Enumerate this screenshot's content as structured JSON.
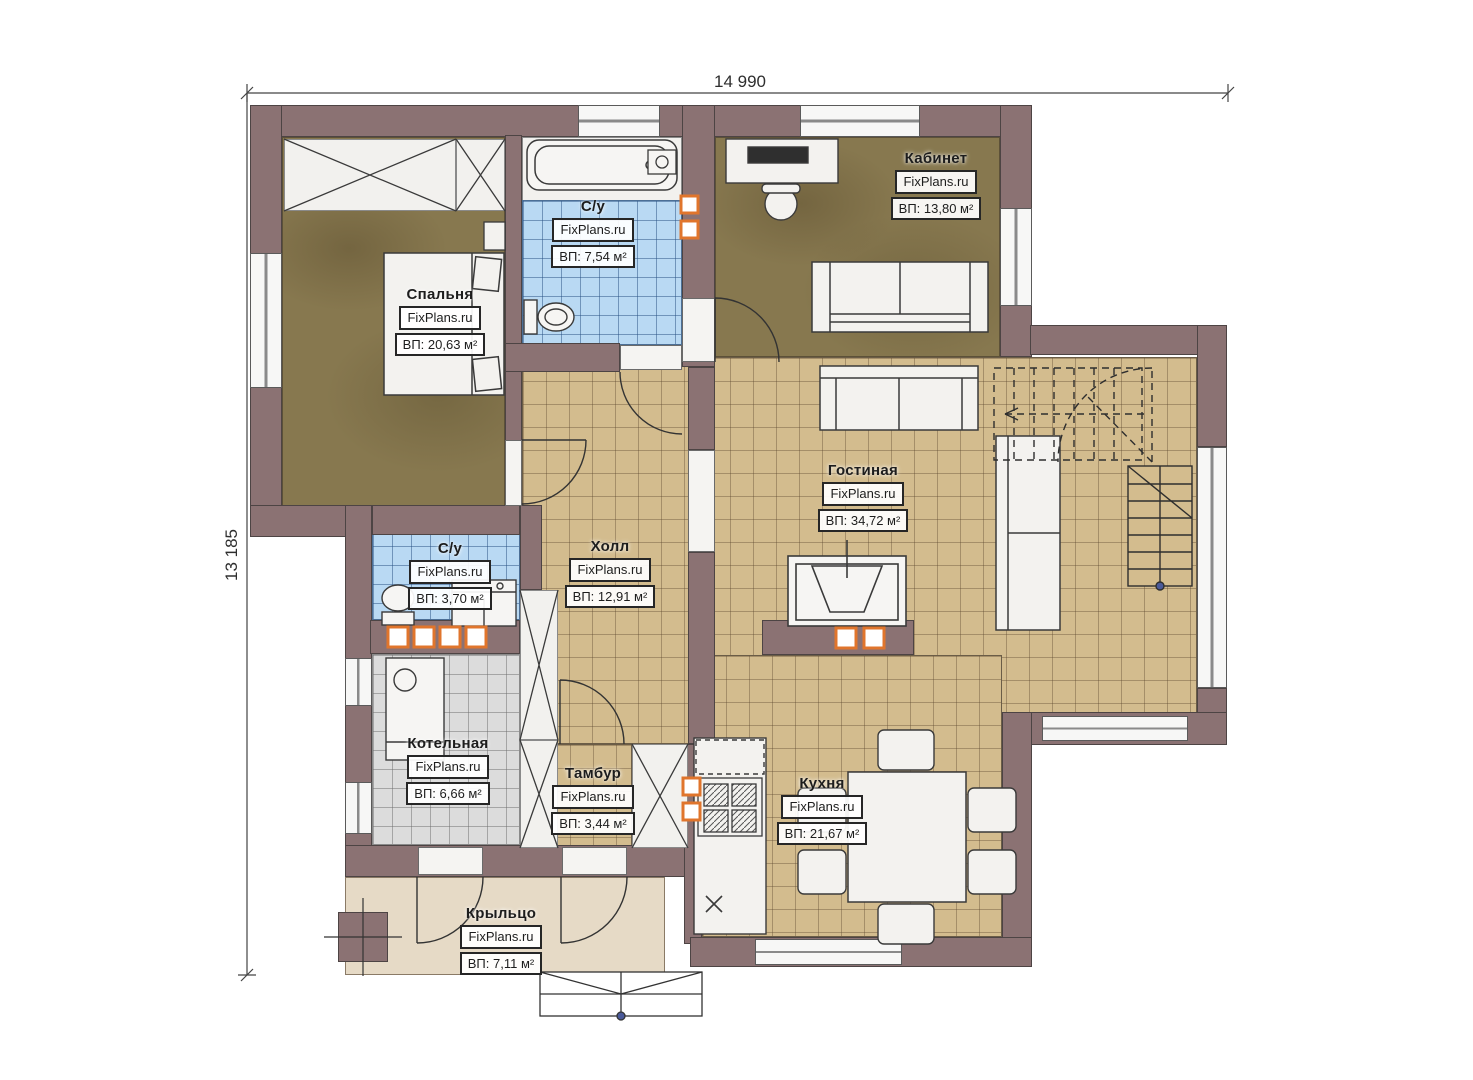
{
  "plan_title": "План первого этажа",
  "brand": "FixPlans.ru",
  "dimensions": {
    "top_width_mm": "14 990",
    "left_height_mm": "13 185"
  },
  "rooms": [
    {
      "name": "Спальня",
      "area": "ВП: 20,63 м²"
    },
    {
      "name": "С/у",
      "area": "ВП: 7,54 м²"
    },
    {
      "name": "Кабинет",
      "area": "ВП: 13,80 м²"
    },
    {
      "name": "Гостиная",
      "area": "ВП: 34,72 м²"
    },
    {
      "name": "Холл",
      "area": "ВП: 12,91 м²"
    },
    {
      "name": "С/у",
      "area": "ВП: 3,70 м²"
    },
    {
      "name": "Котельная",
      "area": "ВП: 6,66 м²"
    },
    {
      "name": "Тамбур",
      "area": "ВП: 3,44 м²"
    },
    {
      "name": "Кухня",
      "area": "ВП: 21,67 м²"
    },
    {
      "name": "Крыльцо",
      "area": "ВП: 7,11 м²"
    }
  ],
  "colors": {
    "wall": "#8b7273",
    "floor_tile_tan": "#d3bc8e",
    "floor_tile_blue": "#b9d9f3",
    "floor_tile_gray": "#dcdcdc",
    "floor_wood_brown": "#87784f",
    "porch_floor": "#e6dac6",
    "vent_accent_orange": "#e0752c"
  },
  "icons": {
    "stairs": "staircase-up-dashed",
    "fireplace": "fireplace",
    "entry_steps": "exterior-steps"
  }
}
